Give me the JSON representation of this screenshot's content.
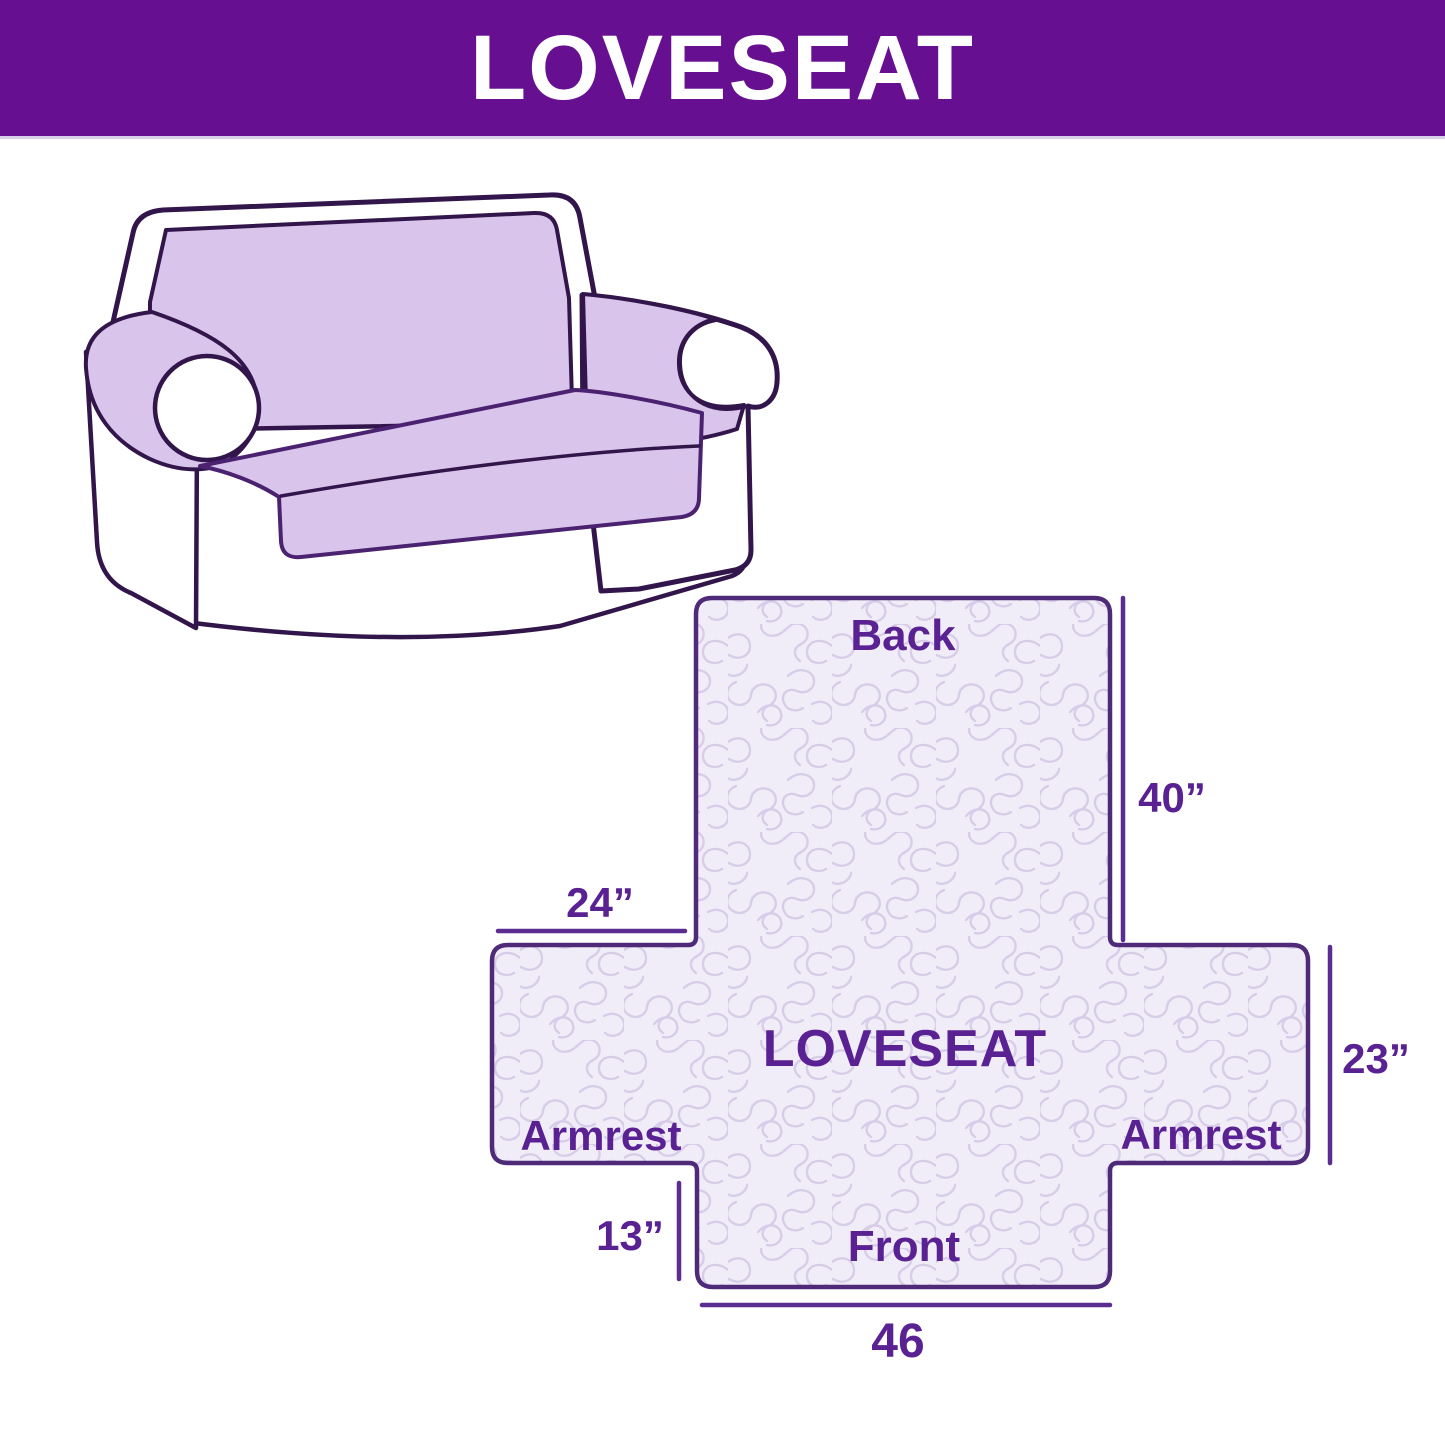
{
  "header": {
    "title": "LOVESEAT"
  },
  "sofa": {
    "description": "Line illustration of a two-seat loveseat sofa with a light lavender slipcover draped over the back, seat and inner armrests",
    "cover_color": "#d9c4eb",
    "outline_color": "#32164b"
  },
  "diagram": {
    "center_label": "LOVESEAT",
    "back_label": "Back",
    "front_label": "Front",
    "armrest_left_label": "Armrest",
    "armrest_right_label": "Armrest",
    "dimensions": {
      "back_height": "40”",
      "armrest_top_width": "24”",
      "armrest_side_height": "23”",
      "front_drop": "13”",
      "front_width": "46"
    },
    "fill_color": "#f1edf8",
    "pattern_line_color": "#d7cde8",
    "border_color": "#4e2a78",
    "label_color": "#5a2193",
    "dimension_line_color": "#5c2d91"
  },
  "colors": {
    "header_bg": "#660f91",
    "header_text": "#ffffff",
    "page_bg": "#ffffff"
  }
}
